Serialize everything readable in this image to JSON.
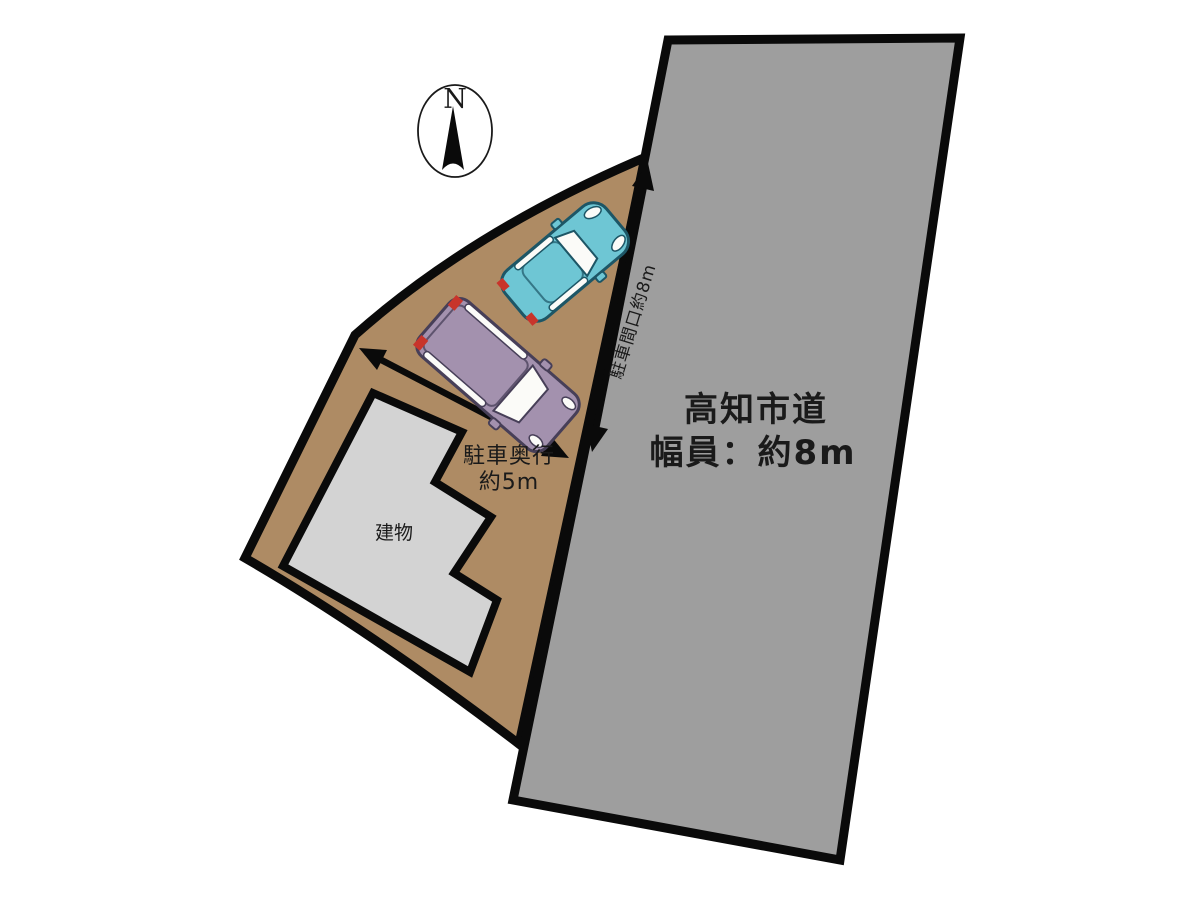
{
  "diagram": {
    "compass_label": "N",
    "road": {
      "name": "高知市道",
      "width_label": "幅員：約8m"
    },
    "dimensions": {
      "frontage_label": "駐車間口約8m",
      "depth_label_line1": "駐車奥行",
      "depth_label_line2": "約5m"
    },
    "building_label": "建物"
  },
  "colors": {
    "lot": "#AE8B64",
    "road": "#9E9E9E",
    "building": "#D3D3D3",
    "outline": "#0a0a0a",
    "arrow": "#0a0a0a",
    "car_teal_body": "#6EC6D4",
    "car_teal_stroke": "#1d5666",
    "van_purple_body": "#A391AE",
    "van_purple_stroke": "#473f58",
    "taillight_red": "#C8342B",
    "glass_white": "#FBFBF8",
    "text": "#1a1a1a"
  }
}
